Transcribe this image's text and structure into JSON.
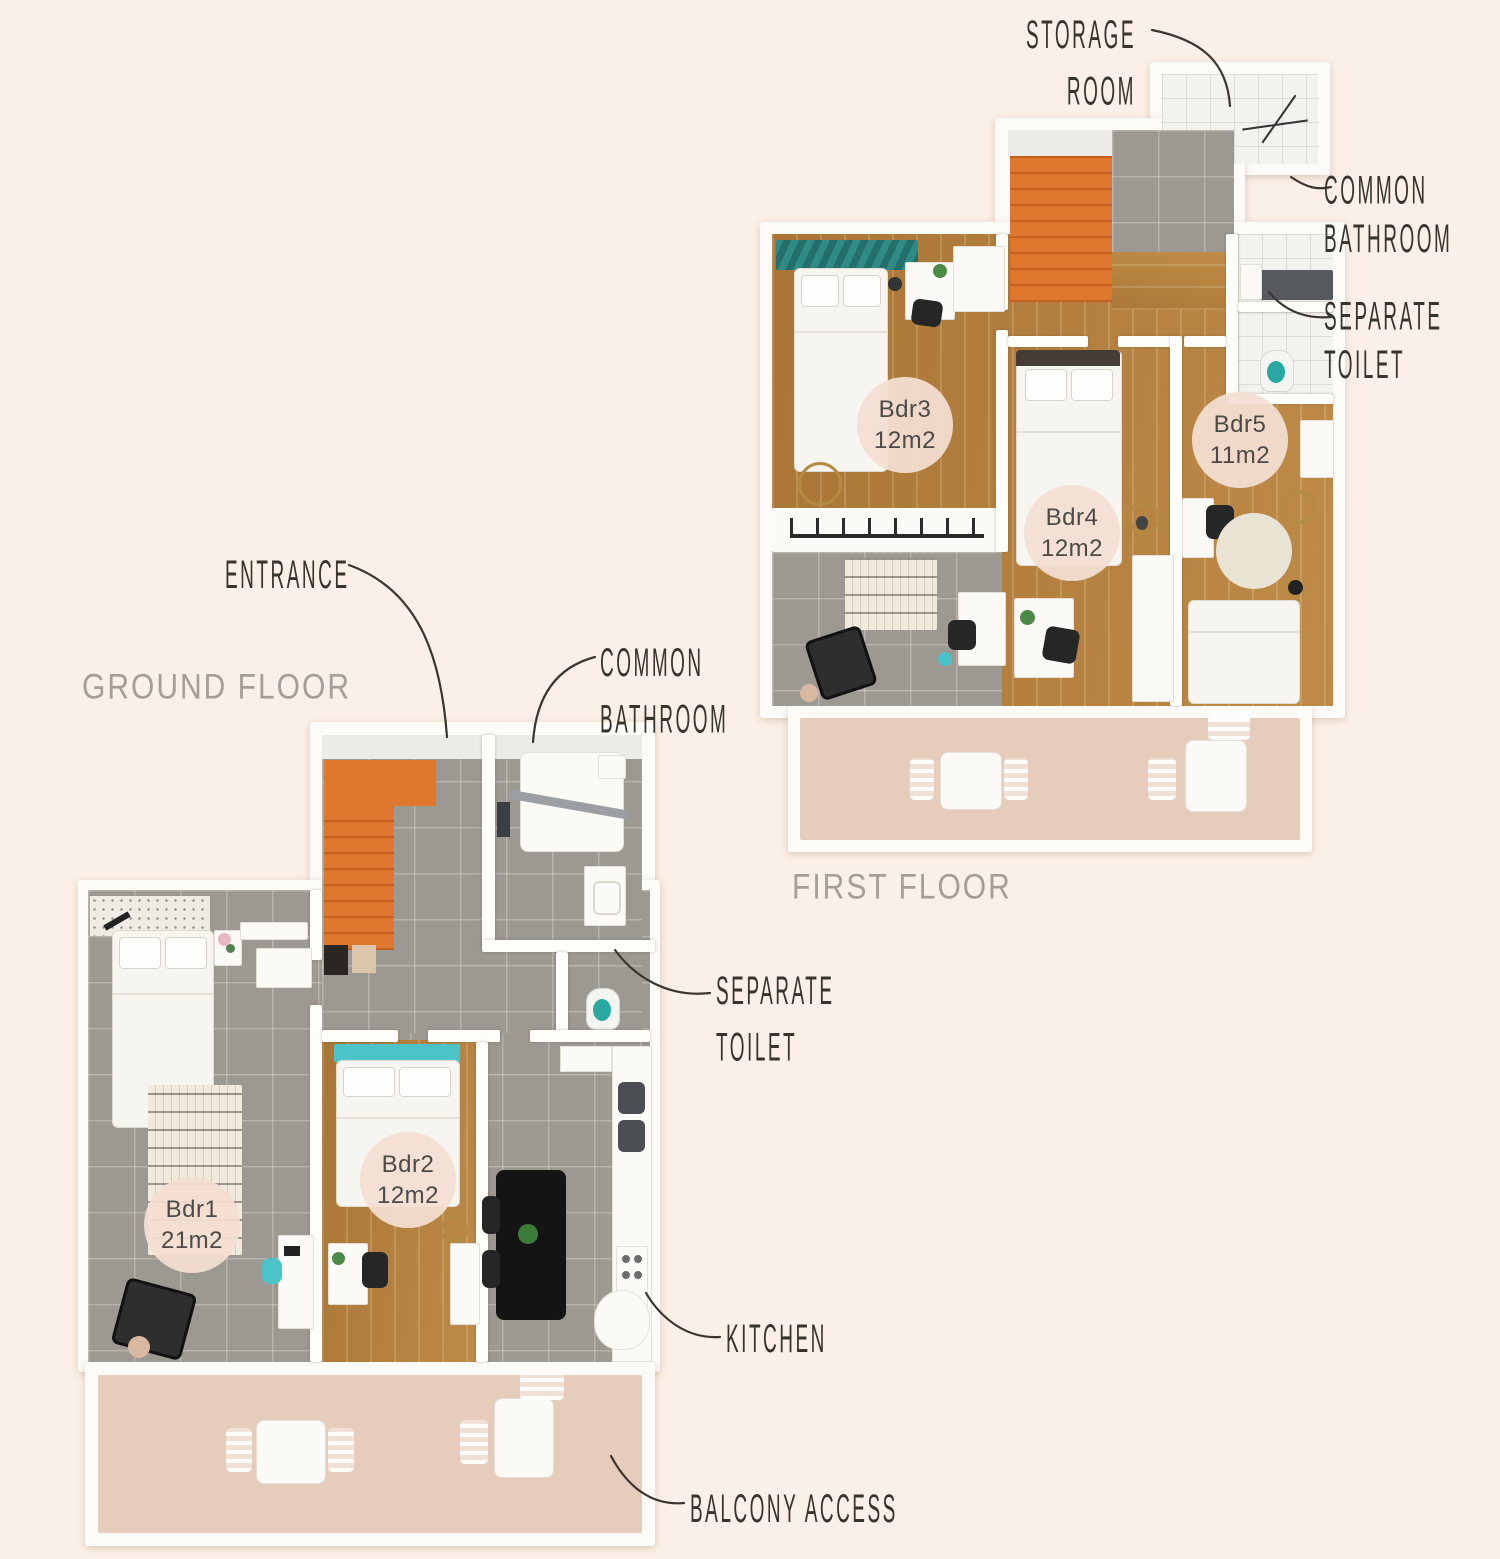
{
  "palette": {
    "background": "#fbf0e7",
    "balcony_floor": "#e6cdbb",
    "wood_floor": "#b5813f",
    "tile_floor": "#9c9892",
    "stairs_orange": "#e0772f",
    "teal_accent": "#2aa9a2",
    "badge_background": "#f3ded1",
    "badge_text": "#4b4a47",
    "annotation_ink": "#37332d",
    "floor_title_color": "#a89d96"
  },
  "ground_floor": {
    "title": "GROUND FLOOR",
    "rooms": [
      {
        "name": "Bdr1",
        "area": "21m2"
      },
      {
        "name": "Bdr2",
        "area": "12m2"
      }
    ],
    "labels": {
      "entrance": "ENTRANCE",
      "common_bathroom_line1": "COMMON",
      "common_bathroom_line2": "BATHROOM",
      "separate_toilet_line1": "SEPARATE",
      "separate_toilet_line2": "TOILET",
      "kitchen": "KITCHEN",
      "balcony_access": "BALCONY ACCESS"
    }
  },
  "first_floor": {
    "title": "FIRST FLOOR",
    "rooms": [
      {
        "name": "Bdr3",
        "area": "12m2"
      },
      {
        "name": "Bdr4",
        "area": "12m2"
      },
      {
        "name": "Bdr5",
        "area": "11m2"
      }
    ],
    "labels": {
      "storage_room_line1": "STORAGE",
      "storage_room_line2": "ROOM",
      "common_bathroom_line1": "COMMON",
      "common_bathroom_line2": "BATHROOM",
      "separate_toilet_line1": "SEPARATE",
      "separate_toilet_line2": "TOILET"
    }
  }
}
